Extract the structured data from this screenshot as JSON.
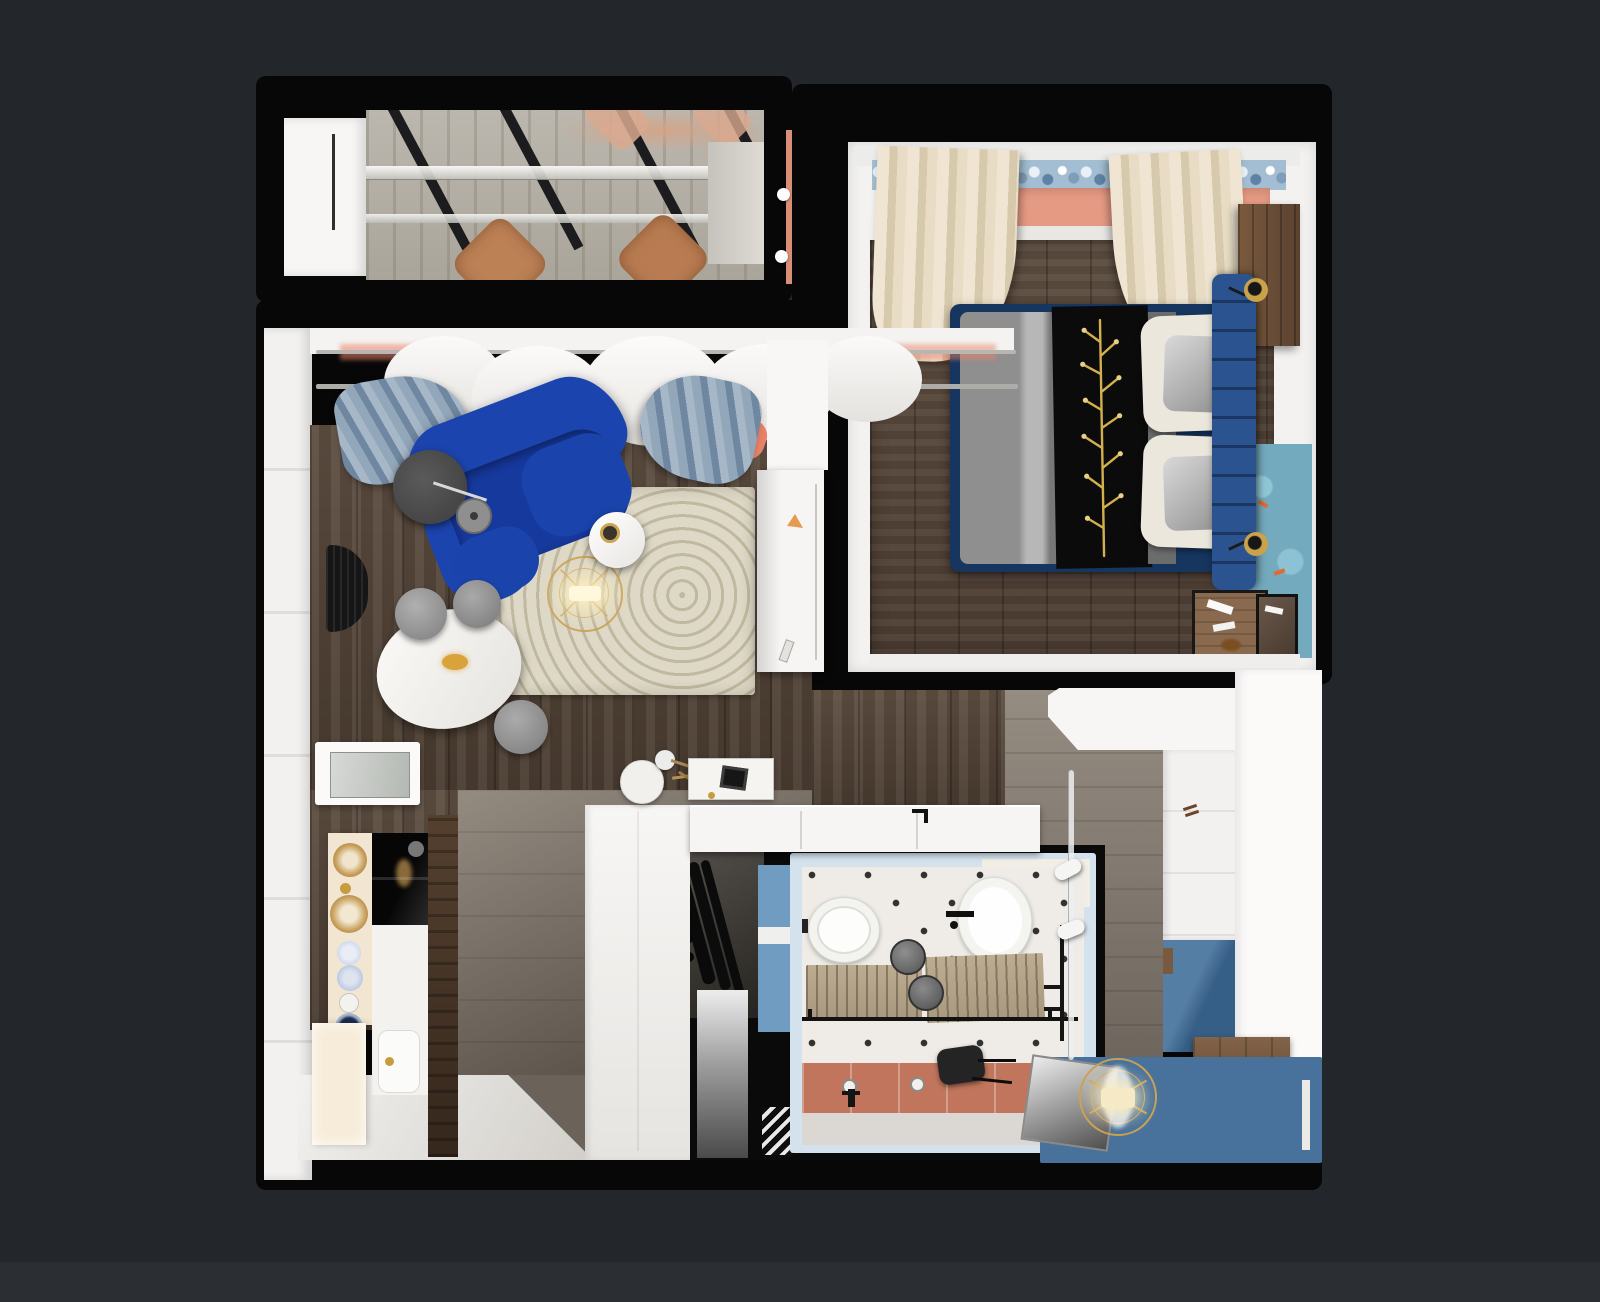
{
  "scene": {
    "description": "Top-down 3D rendered floor plan of a small apartment",
    "background_color": "#23262a",
    "footer_strip_color": "#2b2e33",
    "plan_base_color": "#070707"
  },
  "palette": {
    "white_wall": "#f4f3f1",
    "salmon_wall": "#e59a84",
    "coral_drape": "#e8836a",
    "sofa_blue": "#1c44ae",
    "sofa_seat_blue": "#16399d",
    "bed_base_navy": "#16355f",
    "headboard_blue": "#2a5390",
    "teal_rug": "#74aabd",
    "hall_mat_blue": "#48719b",
    "wardrobe_blue": "#3e6c97",
    "bath_wall_blue": "#6f9cc0",
    "bath_frame_blue": "#d3e2ed",
    "terracotta_floor": "#c0755c",
    "gold_accent": "#c9a050",
    "balcony_salmon_edge": "#d98f76",
    "rug_beige": "#ded8c6"
  },
  "rooms": {
    "balcony": [
      "glass-roof-beams",
      "wood-deck",
      "outdoor-chairs",
      "side-table",
      "storage-cabinet"
    ],
    "bedroom": [
      "double-bed",
      "blue-headboard",
      "pillows",
      "black-throw-gold-branch",
      "cream-curtains",
      "salmon-window-wall",
      "floral-valance",
      "wood-console",
      "teal-koi-rug",
      "wall-sconces",
      "nesting-side-tables"
    ],
    "living_room": [
      "blue-sofa",
      "beige-arc-rug",
      "gold-chandelier",
      "white-side-table",
      "oval-dining-table",
      "gray-poufs",
      "arc-floor-lamp",
      "wall-mesh-decor",
      "glass-wall-cabinet",
      "sheer-curtains",
      "blue-gray-drapes"
    ],
    "kitchen": [
      "cream-shelf-column",
      "amber-glass-decor",
      "black-glass-oven-panel",
      "white-sink",
      "base-cabinet",
      "white-counter-island",
      "black-faucet",
      "decor-tray"
    ],
    "bathroom": [
      "toilet",
      "wash-basin",
      "duckboard-mats",
      "towel-rail",
      "gray-stools",
      "terracotta-floor-band",
      "floor-drains",
      "black-stool",
      "diamond-tile-floor"
    ],
    "hallway": [
      "two-tone-wardrobe",
      "wood-cabinet",
      "blue-floor-mat",
      "caged-fan-light",
      "track-lighting",
      "leaning-mirror",
      "entry-door-niche",
      "coat-rack-corridor",
      "triangle-doormat"
    ]
  }
}
